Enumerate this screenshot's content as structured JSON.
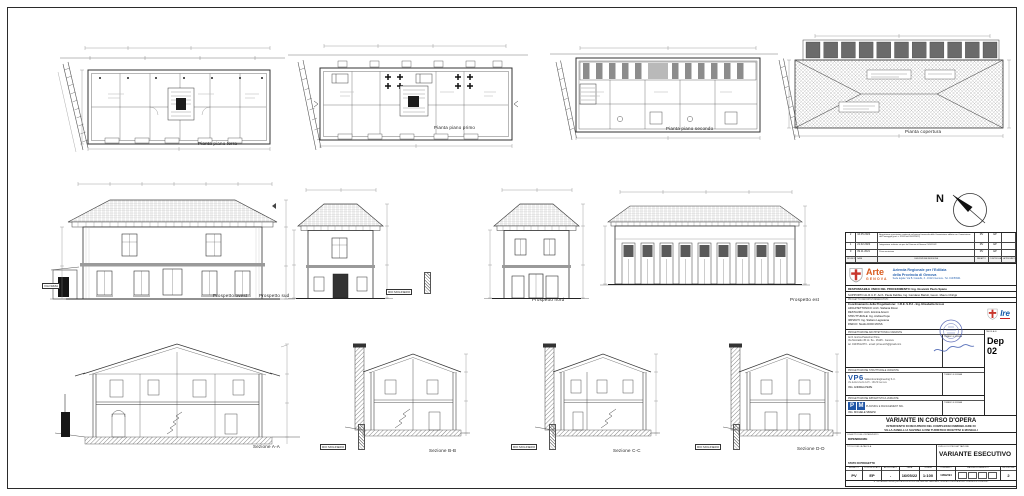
{
  "sheet": {
    "compass": "N",
    "captions": {
      "plan_terra": "Pianta piano terra",
      "plan_primo": "Pianta piano primo",
      "plan_secondo": "Pianta piano secondo",
      "plan_copertura": "Pianta copertura",
      "prospetto_ovest": "Prospetto ovest",
      "prospetto_sud": "Prospetto sud",
      "prospetto_nord": "Prospetto nord",
      "prospetto_est": "Prospetto est",
      "sezione_aa": "Sezione A-A",
      "sezione_bb": "Sezione B-B",
      "sezione_cc": "Sezione C-C",
      "sezione_dd": "Sezione D-D"
    },
    "labels": {
      "rio_molinero": "RIO MOLINERO",
      "via_nizza": "VIA NIZZA"
    }
  },
  "title_block": {
    "revision_table": {
      "headers": [
        "REVISIONE",
        "DATA",
        "DESCRIZIONE REVISIONE",
        "REDATTO",
        "CONTROLLATO",
        "APPROVATO"
      ],
      "rows": [
        {
          "n": "2",
          "date": "16.05.2022",
          "desc": "Acquisizione prescrizioni contenute nel parere favorevole della Commissione edilizia con Commissione del Paesaggio (prot. n. 32033 del 05/05/2022)",
          "r": "RV",
          "c": "EP",
          "a": ""
        },
        {
          "n": "1",
          "date": "21.02.2022",
          "desc": "Integrazione richiesta via pec dal Comune di Savona 21/02/2022",
          "r": "RV",
          "c": "EP",
          "a": ""
        },
        {
          "n": "0",
          "date": "09.11.2021",
          "desc": "Prima emissione",
          "r": "RV",
          "c": "EP",
          "a": ""
        }
      ]
    },
    "agency": {
      "name_top": "Arte",
      "name_bottom": "GENOVA",
      "title_line1": "Azienda Regionale per l'Edilizia",
      "title_line2": "della Provincia di Genova",
      "subtitle": "Sede legale: Via B. Castello, 3 - 16121 Genova - Tel. 010/53901"
    },
    "rup_line": "RESPONSABILE UNICO DEL PROCEDIMENTO: Ing. Giovanni Paolo Spanu",
    "sup_line": "SUPPORTO AL R.U.P.: Arch. Paola Debbia, Ing. Giordano Bartoli, Geom. Mauro Chirigù",
    "prog_def_label": "PROGETTO DEFINITIVO/ESECUTIVO",
    "team": {
      "coord": "Coordinamento della Progettazione: : I.R.E. S.P.A - Ing. Elisabetta Grossi",
      "l1": "ARCHITETTONICO: Arch. Stefania Rossi",
      "l2": "RESTAURO: Arch. Erminia Airenti",
      "l3": "STRUTTURALE: Ing. Andrea Pepe",
      "l4": "IMPIANTI: Ing. Stefano Lagostena",
      "l5": "PARCO: Studio DODI MOSS",
      "ire": "Ire"
    },
    "timbro_label": "TIMBRO E FIRMA",
    "tavola_label": "TAVOLA N.",
    "tavola_value": "Dep 02",
    "arch_section": {
      "header": "PROGETTAZIONE ARCHITETTONICA VARIANTE",
      "line1": "Arch. Enrica Pastorino Prina",
      "line2": "Via Montaldo 45 int. 5a - 16145 - Genova",
      "line3": "tel. 010/3512373 - email: prina.arch@gmail.com"
    },
    "strutt_section": {
      "header": "PROGETTAZIONE STRUTTURALE VARIANTE",
      "logo": "VP6",
      "company": "Valtecnica Engineering S.r.l.",
      "addr": "Via della Libertà 12/3 - 16129 Genova",
      "name": "ING. ANDREA PEPE"
    },
    "imp_section": {
      "header": "PROGETTAZIONE IMPIANTISTICA VARIANTE",
      "logo_p": "P",
      "logo_m": "M",
      "company": "PLANNING E MANAGEMENT SRL",
      "name": "ING. MICHELE SBARSI"
    },
    "project": {
      "title": "VARIANTE IN CORSO D'OPERA",
      "sub1": "INTERVENTO DI RECUPERO DEL COMPLESSO IMMOBILIARE DI",
      "sub2": "VILLA ZANELLI A SAVONA A FINI TURISTICO RICETTIVI E MUSEALI",
      "oggetto_label": "OGGETTO DELL'INTERVENTO",
      "oggetto_value": "DIPENDENZE",
      "titolo_label": "TITOLO DELLA TAVOLA",
      "livello_label": "LIVELLO DI PROGETTAZIONE",
      "stato_label": "STATO DI PROGETTO",
      "stato_value": "VARIANTE ESECUTIVO"
    },
    "footer": {
      "h1": "REDATTO",
      "h2": "CONTROLLATO",
      "h3": "APPROVATO",
      "h4": "DATA",
      "h5": "SCALA",
      "h6": "FORMATO",
      "h7": "RAGGRUPPAMENTO",
      "h8": "REVISIONE",
      "v1": "PV",
      "v2": "EP",
      "v3": "-",
      "v4": "16/05/22",
      "v5": "1:100",
      "v6": "1189x594",
      "v8": "2",
      "disclaimer": "E' VIETATA A CHIUNQUE LA RIPRODUZIONE, ANCHE PARZIALE, NON AUTORIZZATA DEL PRESENTE DISEGNO"
    }
  }
}
